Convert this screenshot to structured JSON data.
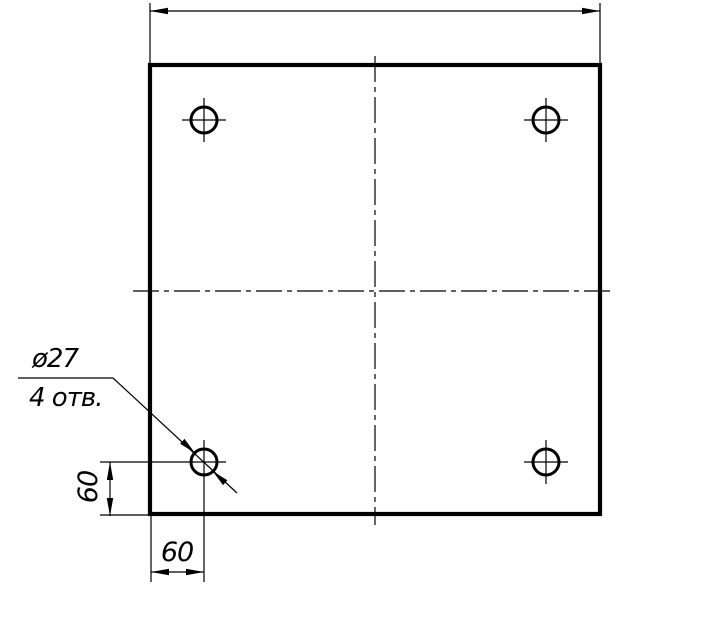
{
  "drawing": {
    "kind": "engineering-drawing",
    "subject": "square plate with four through holes",
    "callout": {
      "diameter_label": "ø27",
      "count_label": "4 отв."
    },
    "dims": {
      "hole_offset_horizontal": "60",
      "hole_offset_vertical": "60"
    },
    "colors": {
      "ink": "#000000",
      "paper": "#ffffff"
    }
  }
}
